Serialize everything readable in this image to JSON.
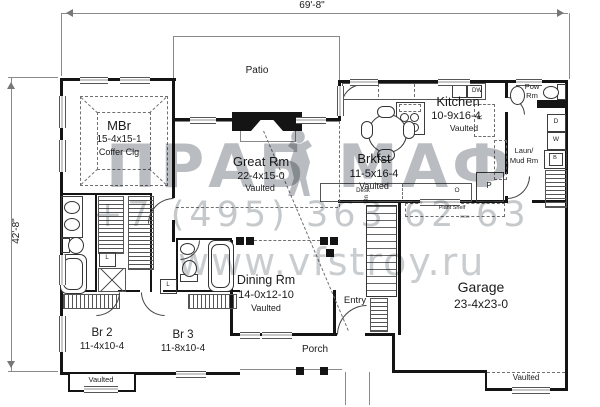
{
  "plan": {
    "dim_width": "69'-8\"",
    "dim_height": "42'-8\"",
    "rooms": {
      "mbr": {
        "name": "MBr",
        "size": "15-4x15-1",
        "note": "Coffer Clg"
      },
      "great": {
        "name": "Great Rm",
        "size": "22-4x15-0",
        "note": "Vaulted"
      },
      "patio": {
        "name": "Patio"
      },
      "kitchen": {
        "name": "Kitchen",
        "size": "10-9x16-4",
        "note": "Vaulted"
      },
      "brkfst": {
        "name": "Brkfst",
        "size": "11-5x16-4",
        "note": "Vaulted"
      },
      "pow": {
        "line1": "Pow",
        "line2": "Rm"
      },
      "laun": {
        "line1": "Laun/",
        "line2": "Mud Rm"
      },
      "dining": {
        "name": "Dining Rm",
        "size": "14-0x12-10",
        "note": "Vaulted"
      },
      "entry": {
        "name": "Entry"
      },
      "garage": {
        "name": "Garage",
        "size": "23-4x23-0",
        "note": "Vaulted"
      },
      "br2": {
        "name": "Br 2",
        "size": "11-4x10-4",
        "note": "Vaulted"
      },
      "br3": {
        "name": "Br 3",
        "size": "11-8x10-4"
      },
      "porch": {
        "name": "Porch"
      }
    },
    "annotations": {
      "plant_shelf": "Plant Shelf",
      "desk": "Desk",
      "dn": "Dn",
      "dw": "DW",
      "p": "P",
      "r": "R",
      "o": "O",
      "d": "D",
      "w": "W",
      "b": "B",
      "l": "L"
    }
  },
  "watermark": {
    "logo_left": "ПРАБ",
    "logo_right": "МАФ",
    "phone": "+7 (495) 363 62-63",
    "website": "www.vfstroy.ru",
    "logo_color": "#8a9096"
  }
}
